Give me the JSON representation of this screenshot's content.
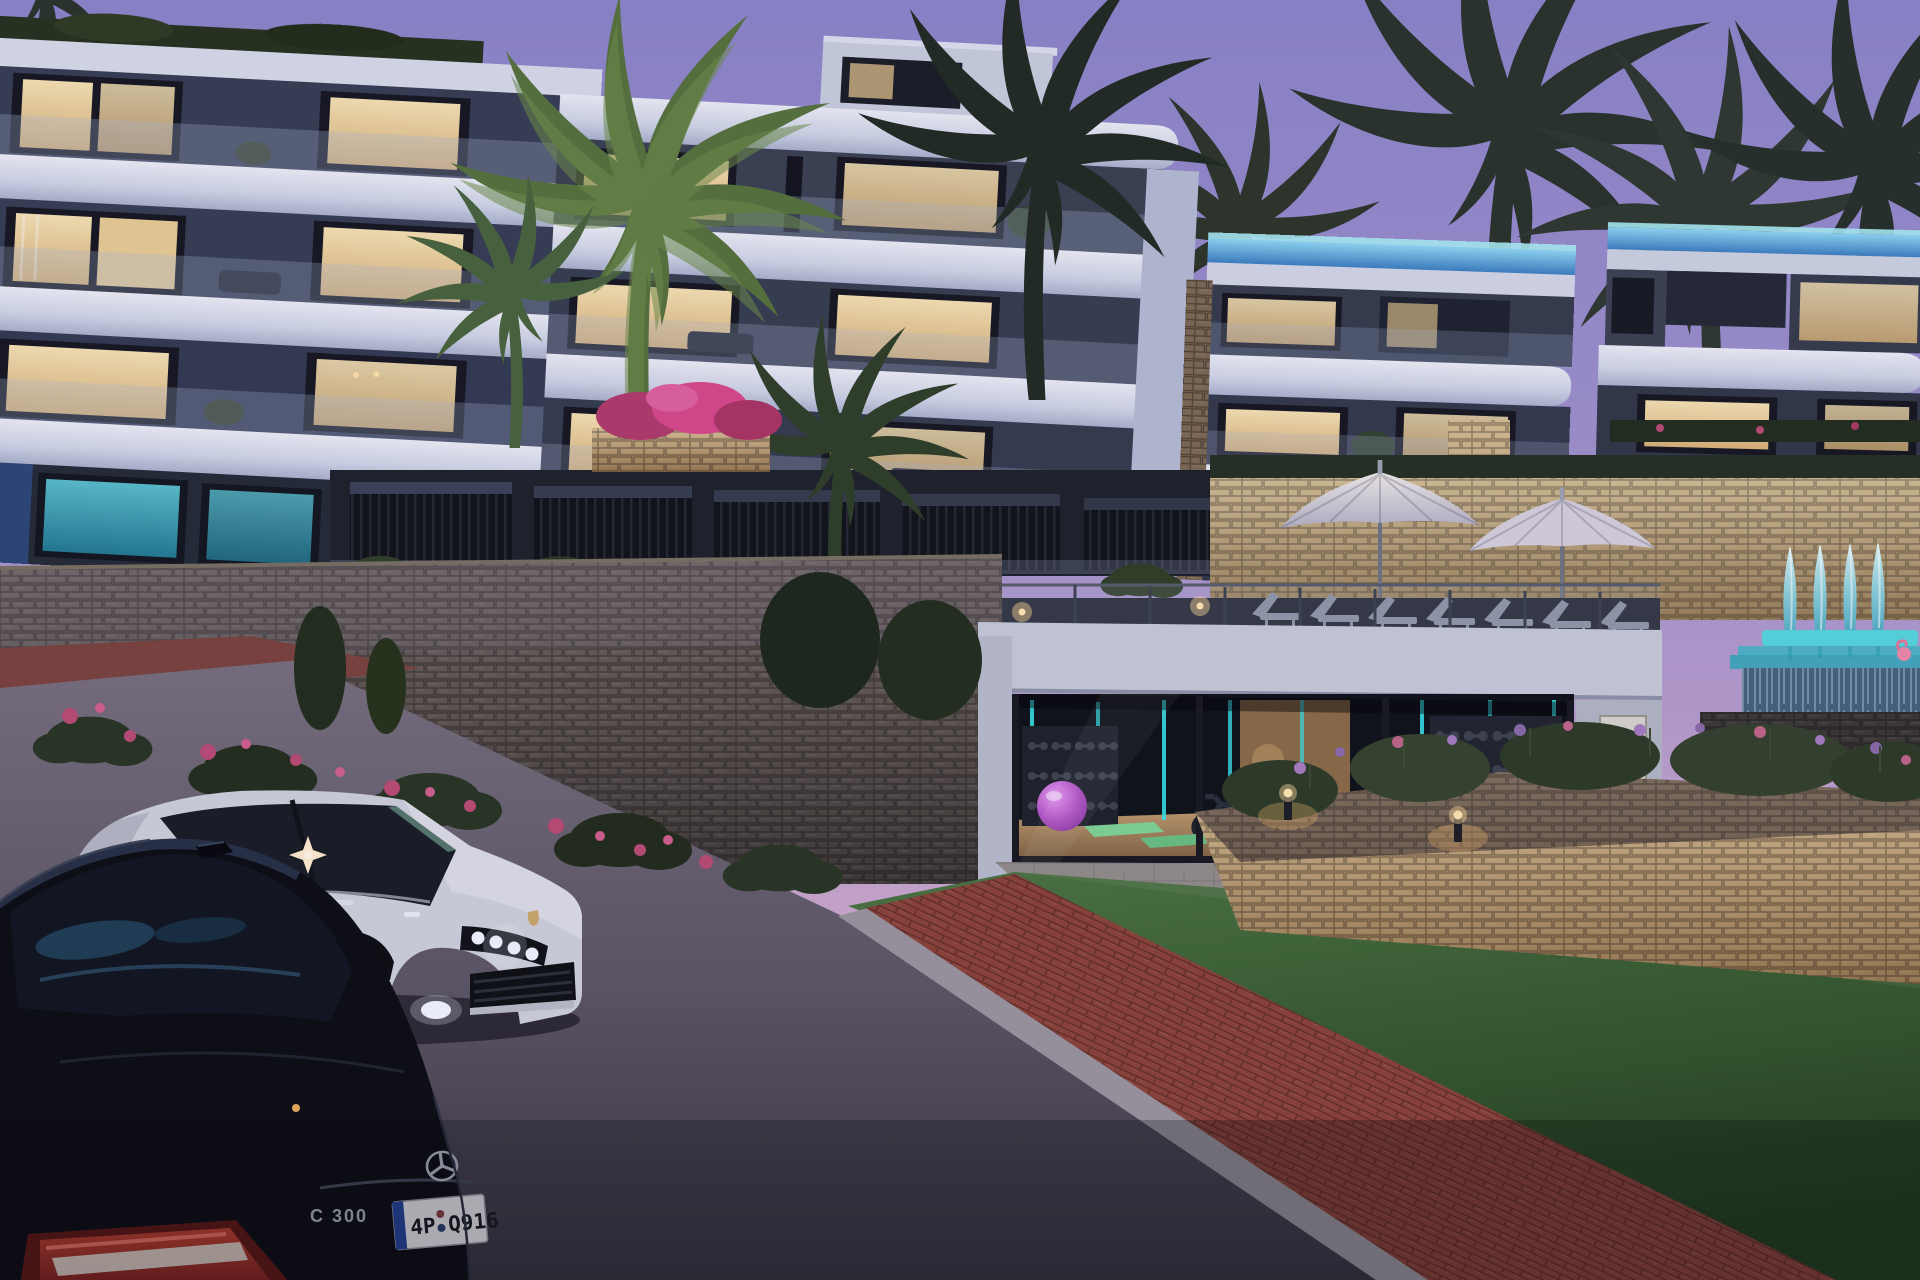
{
  "scene": {
    "title": "Luxury hillside residences at dusk",
    "time_of_day": "dusk",
    "elements": [
      "terraced white apartment buildings with lit balconies",
      "palm trees silhouetted against a purple sky",
      "street-level glass gym with equipment",
      "pool deck with open umbrellas and sun loungers",
      "teal-lit closed umbrellas and infinity pool with flamingo float",
      "stone retaining walls with flowering shrubs",
      "lawn, road with red brick curb strip and two parked cars"
    ]
  },
  "vehicles": {
    "sedan": {
      "color_name": "black",
      "body_color": "#0a0b0f",
      "model_badge": "C 300",
      "license_plate": "4P Q916",
      "plate_left": "4P",
      "plate_right": "Q916",
      "plate_band_color": "#23439c",
      "emblem": "mercedes-star-icon"
    },
    "suv": {
      "color_name": "white",
      "body_color": "#ced1da",
      "emblem": "porsche-crest-icon"
    }
  },
  "lighting": {
    "window_glow": "#eecf96",
    "teal_accent": "#35e2e8",
    "rooftop_pool_glow": "#4f9fd8",
    "umbrella_teal": "#9fe0e4",
    "bollard_warm": "#ffc878"
  },
  "palette": {
    "sky_top": "#8b84c8",
    "sky_horizon": "#e6bcd2",
    "building": "#c5cbe0",
    "fascia": "#e6e9f3",
    "stone_lit": "#c9ad7e",
    "stone_dark": "#5e564e",
    "grass": "#3c6130",
    "asphalt": "#6b6472",
    "brick": "#8a4136"
  },
  "features": {
    "open_umbrellas": 2,
    "closed_teal_umbrellas": 4,
    "sun_loungers": 7,
    "gym": {
      "ball_color": "#b14fc4",
      "mat_color": "#7fd494"
    },
    "flamingo_color": "#ef8aa8"
  }
}
